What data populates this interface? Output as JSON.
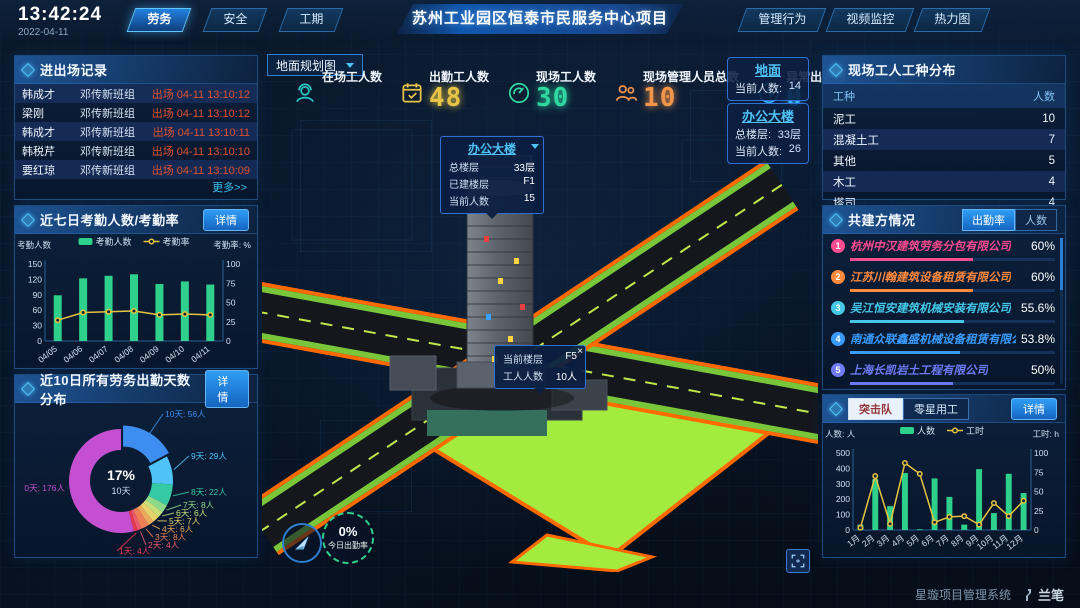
{
  "header": {
    "time": "13:42:24",
    "date": "2022-04-11",
    "title": "苏州工业园区恒泰市民服务中心项目",
    "left_tabs": [
      {
        "label": "劳务",
        "active": true
      },
      {
        "label": "安全",
        "active": false
      },
      {
        "label": "工期",
        "active": false
      }
    ],
    "right_tabs": [
      {
        "label": "管理行为"
      },
      {
        "label": "视频监控"
      },
      {
        "label": "热力图"
      }
    ]
  },
  "entry_exit": {
    "title": "进出场记录",
    "more_label": "更多>>",
    "rows": [
      {
        "name": "韩成才",
        "group": "邓传新班组",
        "event": "出场 04-11 13:10:12"
      },
      {
        "name": "梁刚",
        "group": "邓传新班组",
        "event": "出场 04-11 13:10:12"
      },
      {
        "name": "韩成才",
        "group": "邓传新班组",
        "event": "出场 04-11 13:10:11"
      },
      {
        "name": "韩税芹",
        "group": "邓传新班组",
        "event": "出场 04-11 13:10:10"
      },
      {
        "name": "要红琼",
        "group": "邓传新班组",
        "event": "出场 04-11 13:10:09"
      }
    ]
  },
  "attendance_panel": {
    "title": "近七日考勤人数/考勤率",
    "detail_label": "详情"
  },
  "distribution_panel": {
    "title": "近10日所有劳务出勤天数分布",
    "detail_label": "详情"
  },
  "map": {
    "layer_select": "地面规划图",
    "stats": [
      {
        "label": "在场工人数",
        "value": "",
        "color": "#27c5c3",
        "icon": "worker-icon"
      },
      {
        "label": "出勤工人数",
        "value": "48",
        "color": "#e8c547",
        "icon": "calendar-check-icon"
      },
      {
        "label": "现场工人数",
        "value": "30",
        "color": "#2fd8a0",
        "icon": "gauge-icon"
      },
      {
        "label": "现场管理人员总数",
        "value": "10",
        "color": "#f0954a",
        "icon": "people-icon"
      },
      {
        "label": "异常出勤数",
        "value": "0",
        "color": "#35b5f5",
        "icon": "pulse-icon"
      }
    ],
    "ground_panel": {
      "title": "地面",
      "rows": [
        [
          "当前人数:",
          "14"
        ]
      ]
    },
    "office_panel": {
      "title": "办公大楼",
      "rows": [
        [
          "总楼层:",
          "33层"
        ],
        [
          "当前人数:",
          "26"
        ]
      ]
    },
    "building_tooltip": {
      "title": "办公大楼",
      "rows": [
        [
          "总楼层",
          "33层"
        ],
        [
          "已建楼层",
          "F1"
        ],
        [
          "当前人数",
          "15"
        ]
      ]
    },
    "floor_tooltip": {
      "close": "×",
      "rows": [
        [
          "当前楼层",
          "F5"
        ],
        [
          "工人人数",
          "10人"
        ]
      ]
    },
    "gauge": {
      "value": "0%",
      "label": "今日出勤率"
    }
  },
  "worker_types": {
    "title": "现场工人工种分布",
    "headers": [
      "工种",
      "人数"
    ],
    "rows": [
      [
        "泥工",
        "10"
      ],
      [
        "混凝土工",
        "7"
      ],
      [
        "其他",
        "5"
      ],
      [
        "木工",
        "4"
      ],
      [
        "塔司",
        "4"
      ]
    ]
  },
  "partners": {
    "title": "共建方情况",
    "tabs": [
      {
        "label": "出勤率",
        "active": true
      },
      {
        "label": "人数",
        "active": false
      }
    ],
    "companies": [
      {
        "rank": "1",
        "name": "杭州中汉建筑劳务分包有限公司",
        "value": "60%",
        "pct": 60,
        "color": "#ff4b8f"
      },
      {
        "rank": "2",
        "name": "江苏川翰建筑设备租赁有限公司",
        "value": "60%",
        "pct": 60,
        "color": "#ff8a3d"
      },
      {
        "rank": "3",
        "name": "吴江恒安建筑机械安装有限公司",
        "value": "55.6%",
        "pct": 55.6,
        "color": "#45c8e8"
      },
      {
        "rank": "4",
        "name": "南通众联鑫盛机械设备租赁有限公司",
        "value": "53.8%",
        "pct": 53.8,
        "color": "#3a9bff"
      },
      {
        "rank": "5",
        "name": "上海长凯岩土工程有限公司",
        "value": "50%",
        "pct": 50,
        "color": "#6f7bf7"
      },
      {
        "rank": "6",
        "name": "江苏洁治建筑安装工程有限公司",
        "value": "35.4%",
        "pct": 35.4,
        "color": "#8a5cf5"
      }
    ]
  },
  "squad_panel": {
    "tabs": [
      {
        "label": "突击队",
        "active": true
      },
      {
        "label": "零星用工",
        "active": false
      }
    ],
    "detail_label": "详情"
  },
  "footer": {
    "system_name": "星璇项目管理系统",
    "logo": "兰笔"
  },
  "chart_data": [
    {
      "id": "attendance7d",
      "type": "bar",
      "title": "近七日考勤人数/考勤率",
      "categories": [
        "04/05",
        "04/06",
        "04/07",
        "04/08",
        "04/09",
        "04/10",
        "04/11"
      ],
      "series": [
        {
          "name": "考勤人数",
          "kind": "bar",
          "axis": "left",
          "color": "#2fd08c",
          "values": [
            89,
            122,
            127,
            130,
            111,
            116,
            110
          ]
        },
        {
          "name": "考勤率",
          "kind": "line",
          "axis": "right",
          "color": "#e6c440",
          "values": [
            27,
            37,
            38,
            39,
            34,
            35,
            34
          ]
        }
      ],
      "axis_left": {
        "label": "考勤人数",
        "lim": [
          0,
          150
        ],
        "ticks": [
          0,
          30,
          60,
          90,
          120,
          150
        ]
      },
      "axis_right": {
        "label": "考勤率: %",
        "lim": [
          0,
          100
        ],
        "ticks": [
          0,
          25,
          50,
          75,
          100
        ]
      },
      "legend_position": "top",
      "grid": false
    },
    {
      "id": "days10",
      "type": "pie",
      "title": "近10日所有劳务出勤天数分布",
      "center": {
        "value": "17%",
        "label": "10天"
      },
      "unit": "人",
      "slices": [
        {
          "label": "10天",
          "count": 56,
          "color": "#3d8ef0"
        },
        {
          "label": "9天",
          "count": 29,
          "color": "#4fc3f7"
        },
        {
          "label": "8天",
          "count": 22,
          "color": "#35c9a4"
        },
        {
          "label": "7天",
          "count": 8,
          "color": "#8fd98a"
        },
        {
          "label": "6天",
          "count": 6,
          "color": "#c9e07a"
        },
        {
          "label": "5天",
          "count": 7,
          "color": "#e6d26b"
        },
        {
          "label": "4天",
          "count": 6,
          "color": "#eba95c"
        },
        {
          "label": "3天",
          "count": 8,
          "color": "#ef7f56"
        },
        {
          "label": "2天",
          "count": 4,
          "color": "#f05a6e"
        },
        {
          "label": "1天",
          "count": 4,
          "color": "#e83a4e"
        },
        {
          "label": "0天",
          "count": 176,
          "color": "#c44fd1"
        }
      ]
    },
    {
      "id": "squad",
      "type": "bar",
      "title": "突击队",
      "categories": [
        "1月",
        "2月",
        "3月",
        "4月",
        "5月",
        "6月",
        "7月",
        "8月",
        "9月",
        "10月",
        "11月",
        "12月"
      ],
      "series": [
        {
          "name": "人数",
          "kind": "bar",
          "axis": "left",
          "color": "#2fd08c",
          "values": [
            35,
            330,
            155,
            370,
            5,
            335,
            215,
            35,
            395,
            110,
            365,
            240
          ]
        },
        {
          "name": "工时",
          "kind": "line",
          "axis": "right",
          "color": "#e6c440",
          "values": [
            3,
            70,
            8,
            87,
            73,
            10,
            17,
            18,
            7,
            35,
            18,
            38
          ]
        }
      ],
      "axis_left": {
        "label": "人数: 人",
        "lim": [
          0,
          500
        ],
        "ticks": [
          0,
          100,
          200,
          300,
          400,
          500
        ]
      },
      "axis_right": {
        "label": "工时: h",
        "lim": [
          0,
          100
        ],
        "ticks": [
          0,
          25,
          50,
          75,
          100
        ]
      },
      "legend_position": "top",
      "grid": false
    }
  ]
}
